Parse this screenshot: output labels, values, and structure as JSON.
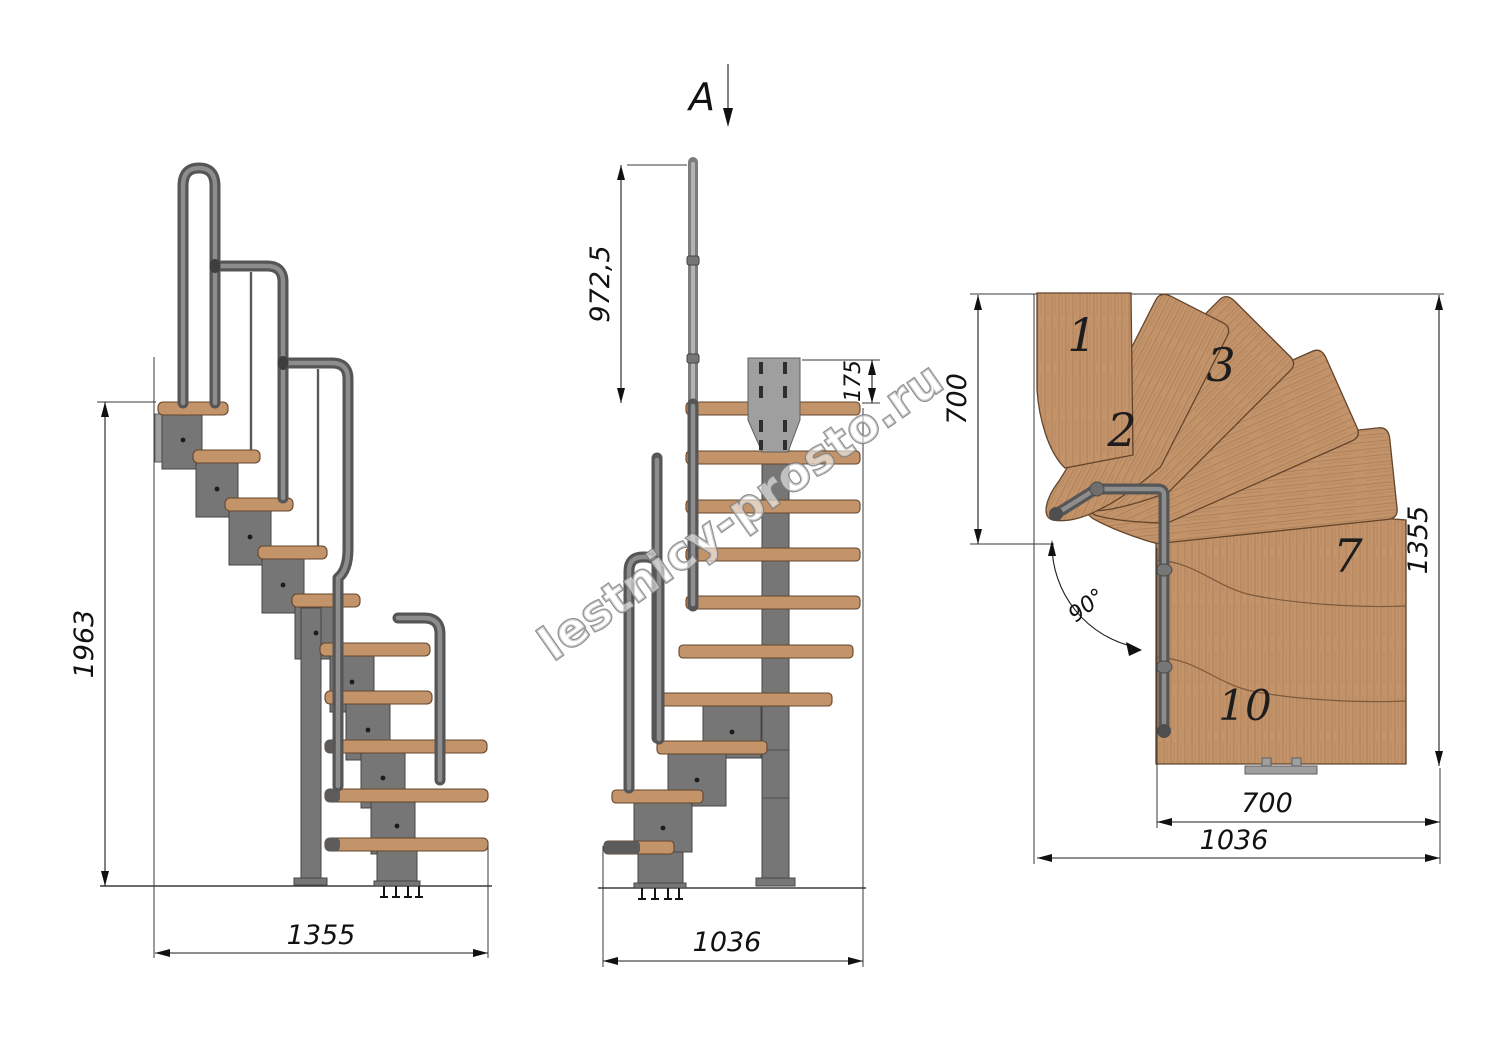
{
  "watermark": {
    "text": "lestnicy-prosto.ru"
  },
  "views": {
    "side": {
      "title": "side elevation",
      "dim_height": "1963",
      "dim_width": "1355"
    },
    "front": {
      "title": "front elevation",
      "section_label": "A",
      "dim_handrail_height": "972,5",
      "dim_plate_height": "175",
      "dim_width": "1036"
    },
    "plan": {
      "title": "top plan view",
      "dim_landing_depth": "700",
      "dim_total_depth": "1355",
      "dim_flight_width": "700",
      "dim_total_width": "1036",
      "dim_turn_angle": "90°",
      "tread_numbers": {
        "t1": "1",
        "t2": "2",
        "t3": "3",
        "t7": "7",
        "t10": "10"
      }
    }
  },
  "colors": {
    "background": "#ffffff",
    "wood": "#c3936a",
    "wood_edge": "#63452c",
    "steel": "#767676",
    "steel_dark": "#454545",
    "handrail": "#565656",
    "dimension": "#1c1c1c"
  }
}
